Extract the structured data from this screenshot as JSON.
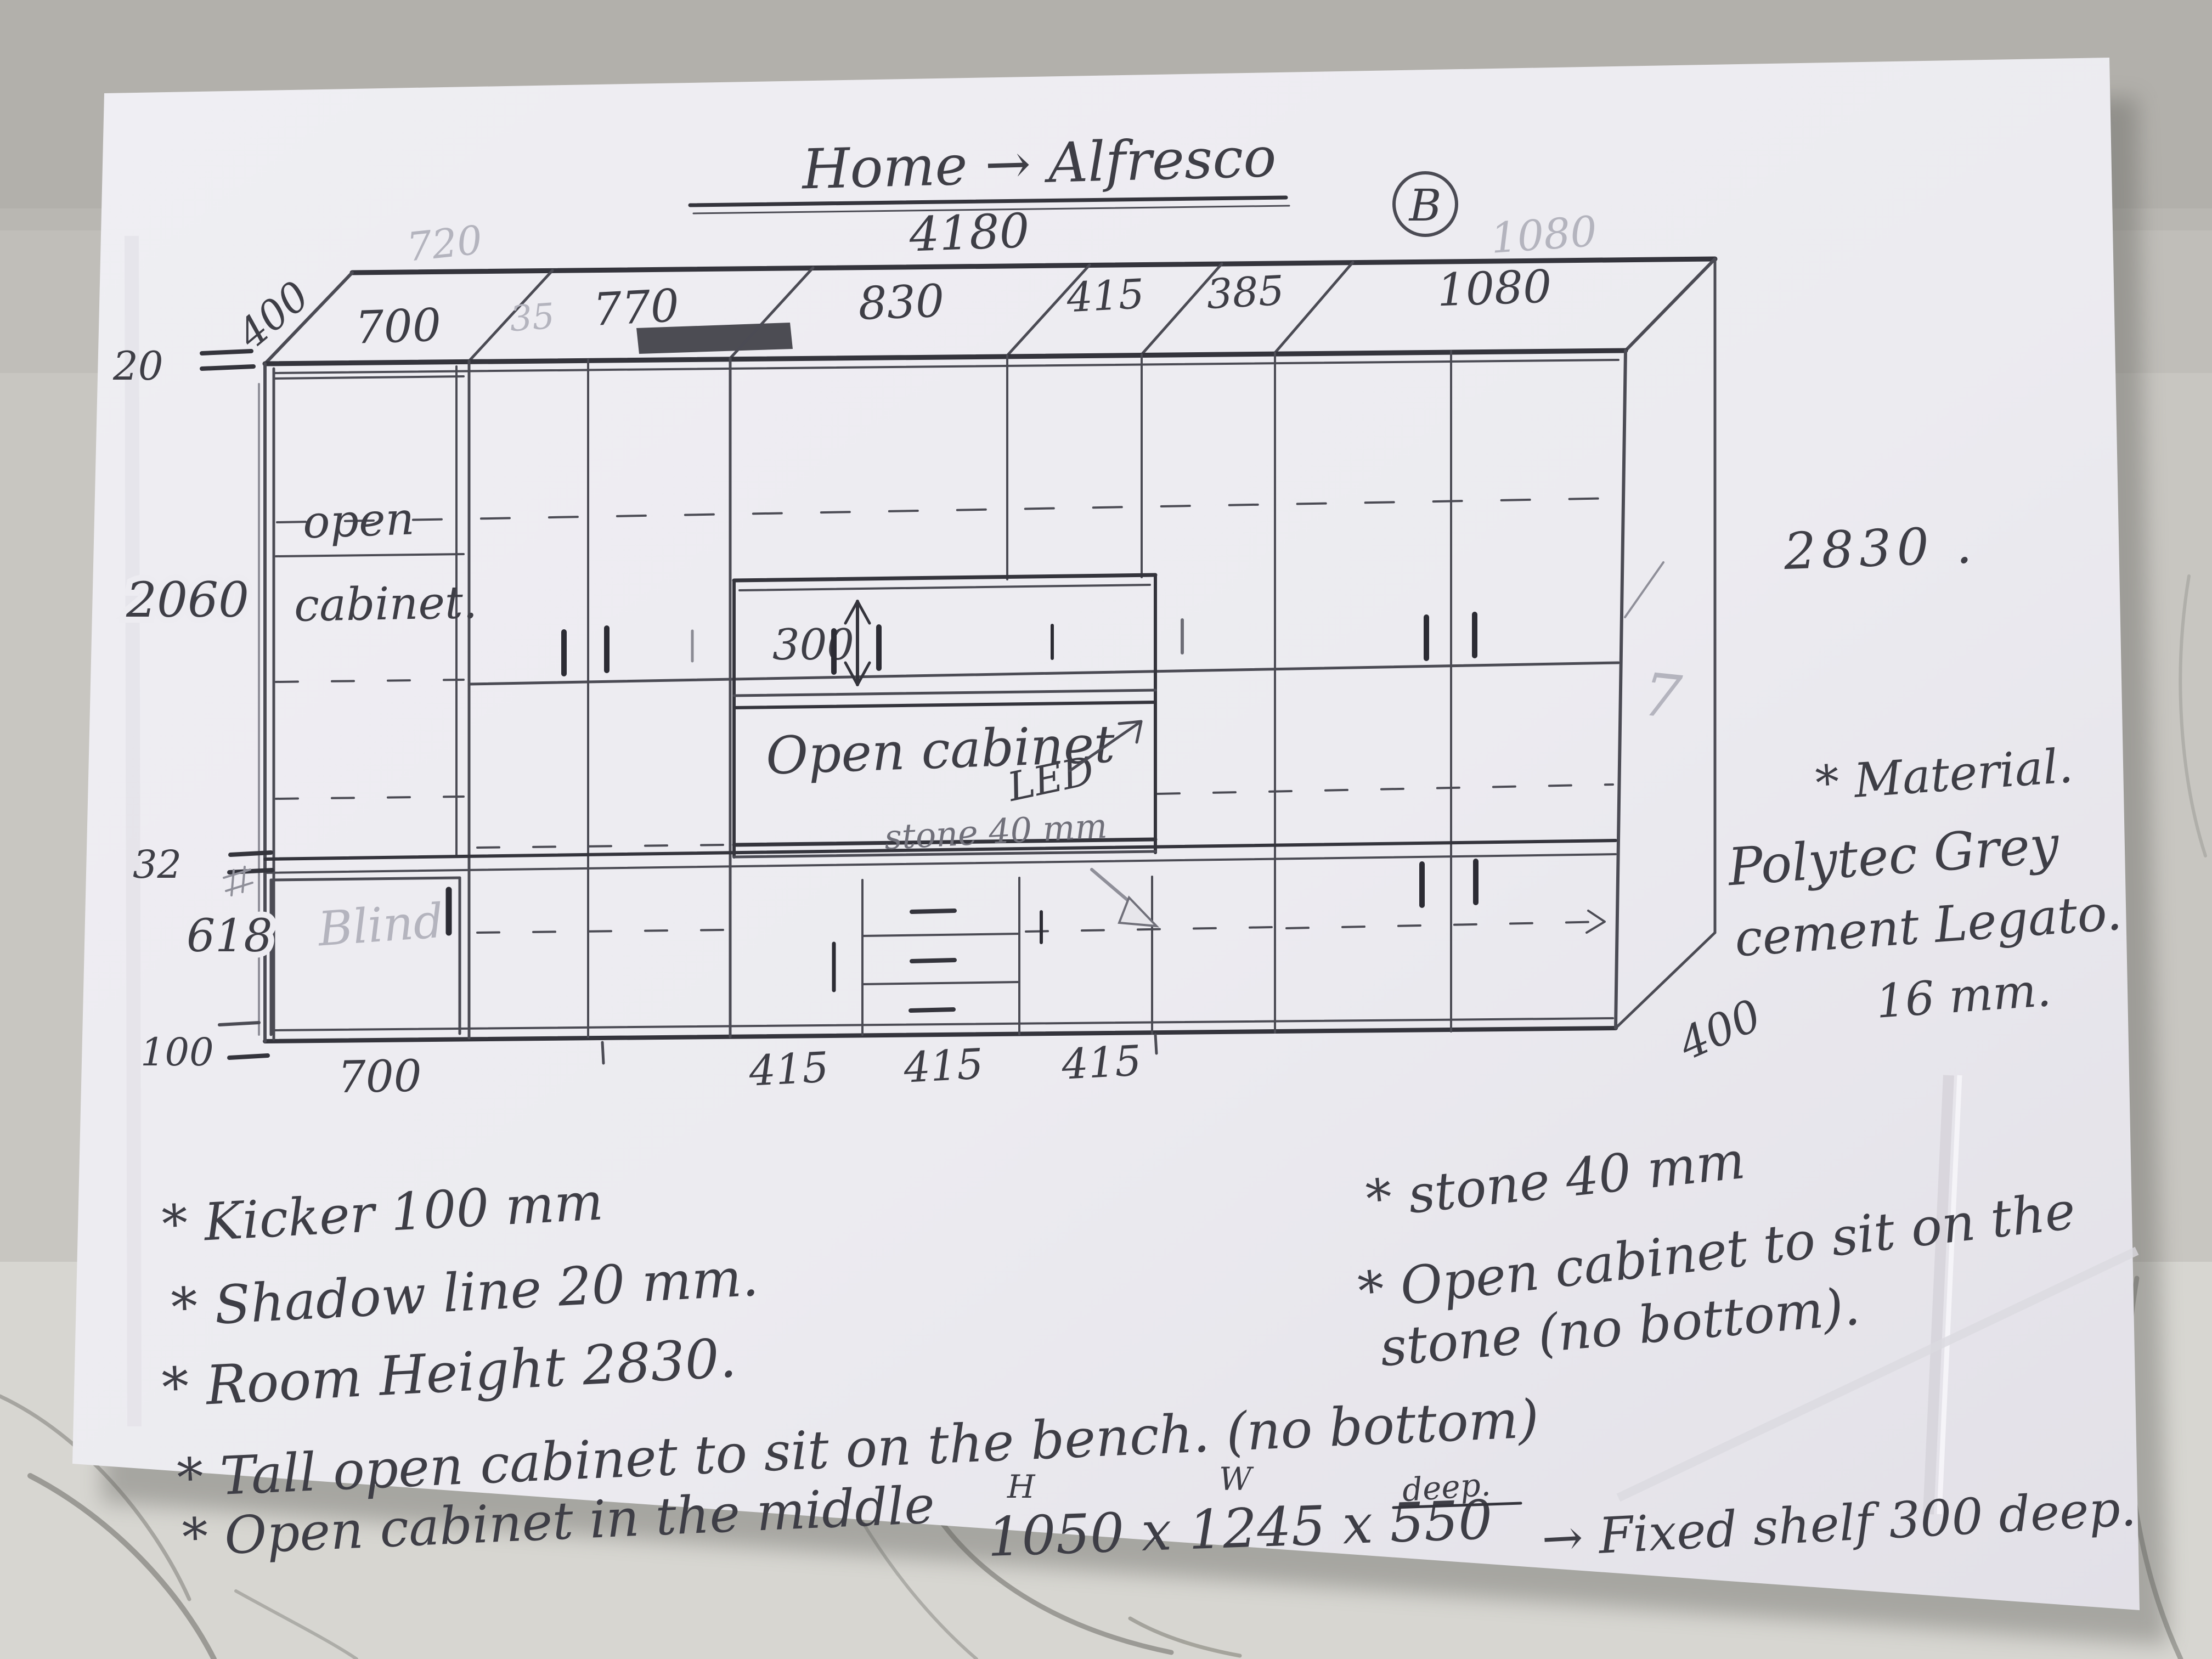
{
  "title": {
    "text": "Home → Alfresco",
    "width_label": "4180",
    "revision": "B",
    "ghost_width": "1080"
  },
  "top_band": {
    "depth_label": "400",
    "ghost_720": "720",
    "ghost_35": "35",
    "segments": [
      "700",
      "770",
      "830",
      "415",
      "385",
      "1080"
    ]
  },
  "left_dims": {
    "shadow_line": "20",
    "tall": "2060",
    "bench": "32",
    "base": "618",
    "kicker": "100"
  },
  "bottom_dims": [
    "700",
    "415",
    "415",
    "415"
  ],
  "right_side": {
    "room_height": "2830 .",
    "ghost_mark": "7",
    "depth": "400"
  },
  "cabinet_labels": {
    "open_line1": "open",
    "open_line2": "cabinet.",
    "blind": "Blind",
    "shelf_300": "300",
    "open_mid": "Open cabinet",
    "led": "LED",
    "stone_inline": "stone 40 mm"
  },
  "material_note": {
    "l1": "* Material.",
    "l2": "Polytec Grey",
    "l3": "cement Legato.",
    "l4": "16 mm."
  },
  "notes_left": {
    "l1": "* Kicker 100 mm",
    "l2": "* Shadow line 20 mm.",
    "l3": "* Room Height 2830.",
    "l4": "* Tall open cabinet to sit on the bench. (no bottom)",
    "l5_prefix": "* Open cabinet in the middle",
    "l5_dims": "1050 x 1245 x 550",
    "l5_sup_h": "H",
    "l5_sup_w": "W",
    "l5_sup_d": "deep.",
    "l5_suffix": "→ Fixed shelf 300 deep."
  },
  "notes_right": {
    "l1": "* stone 40 mm",
    "l2": "* Open cabinet to sit on the",
    "l3": "stone (no bottom)."
  }
}
